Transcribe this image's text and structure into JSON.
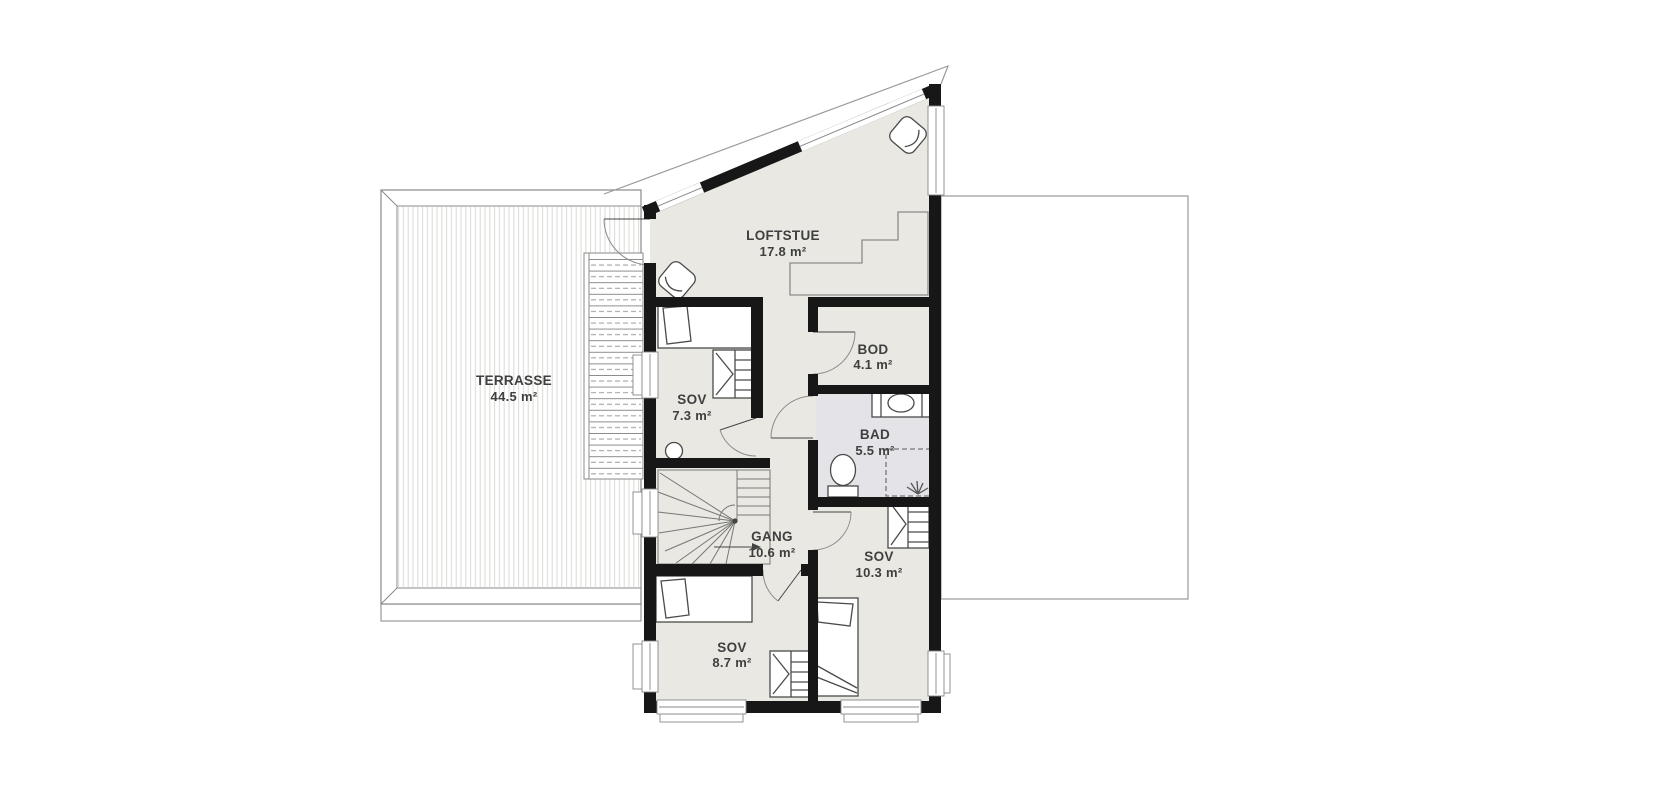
{
  "plan": {
    "type": "floor-plan",
    "rooms": [
      {
        "name": "LOFTSTUE",
        "area": "17.8 m²"
      },
      {
        "name": "TERRASSE",
        "area": "44.5 m²"
      },
      {
        "name": "SOV",
        "area": "7.3 m²"
      },
      {
        "name": "BOD",
        "area": "4.1 m²"
      },
      {
        "name": "BAD",
        "area": "5.5 m²"
      },
      {
        "name": "GANG",
        "area": "10.6 m²"
      },
      {
        "name": "SOV",
        "area": "10.3 m²"
      },
      {
        "name": "SOV",
        "area": "8.7 m²"
      }
    ],
    "fixtures": [
      "bed",
      "wardrobe",
      "toilet",
      "vanity-sink",
      "shower",
      "winder-stairs",
      "exterior-stairs",
      "armchair",
      "corner-bench",
      "stool"
    ],
    "colors": {
      "wall": "#171717",
      "floor": "#e9e8e2",
      "bath_floor": "#e3e3e8",
      "outline": "#9a9a9a",
      "deck_stripe": "#d9d9d5",
      "text": "#3f3f3f"
    }
  }
}
